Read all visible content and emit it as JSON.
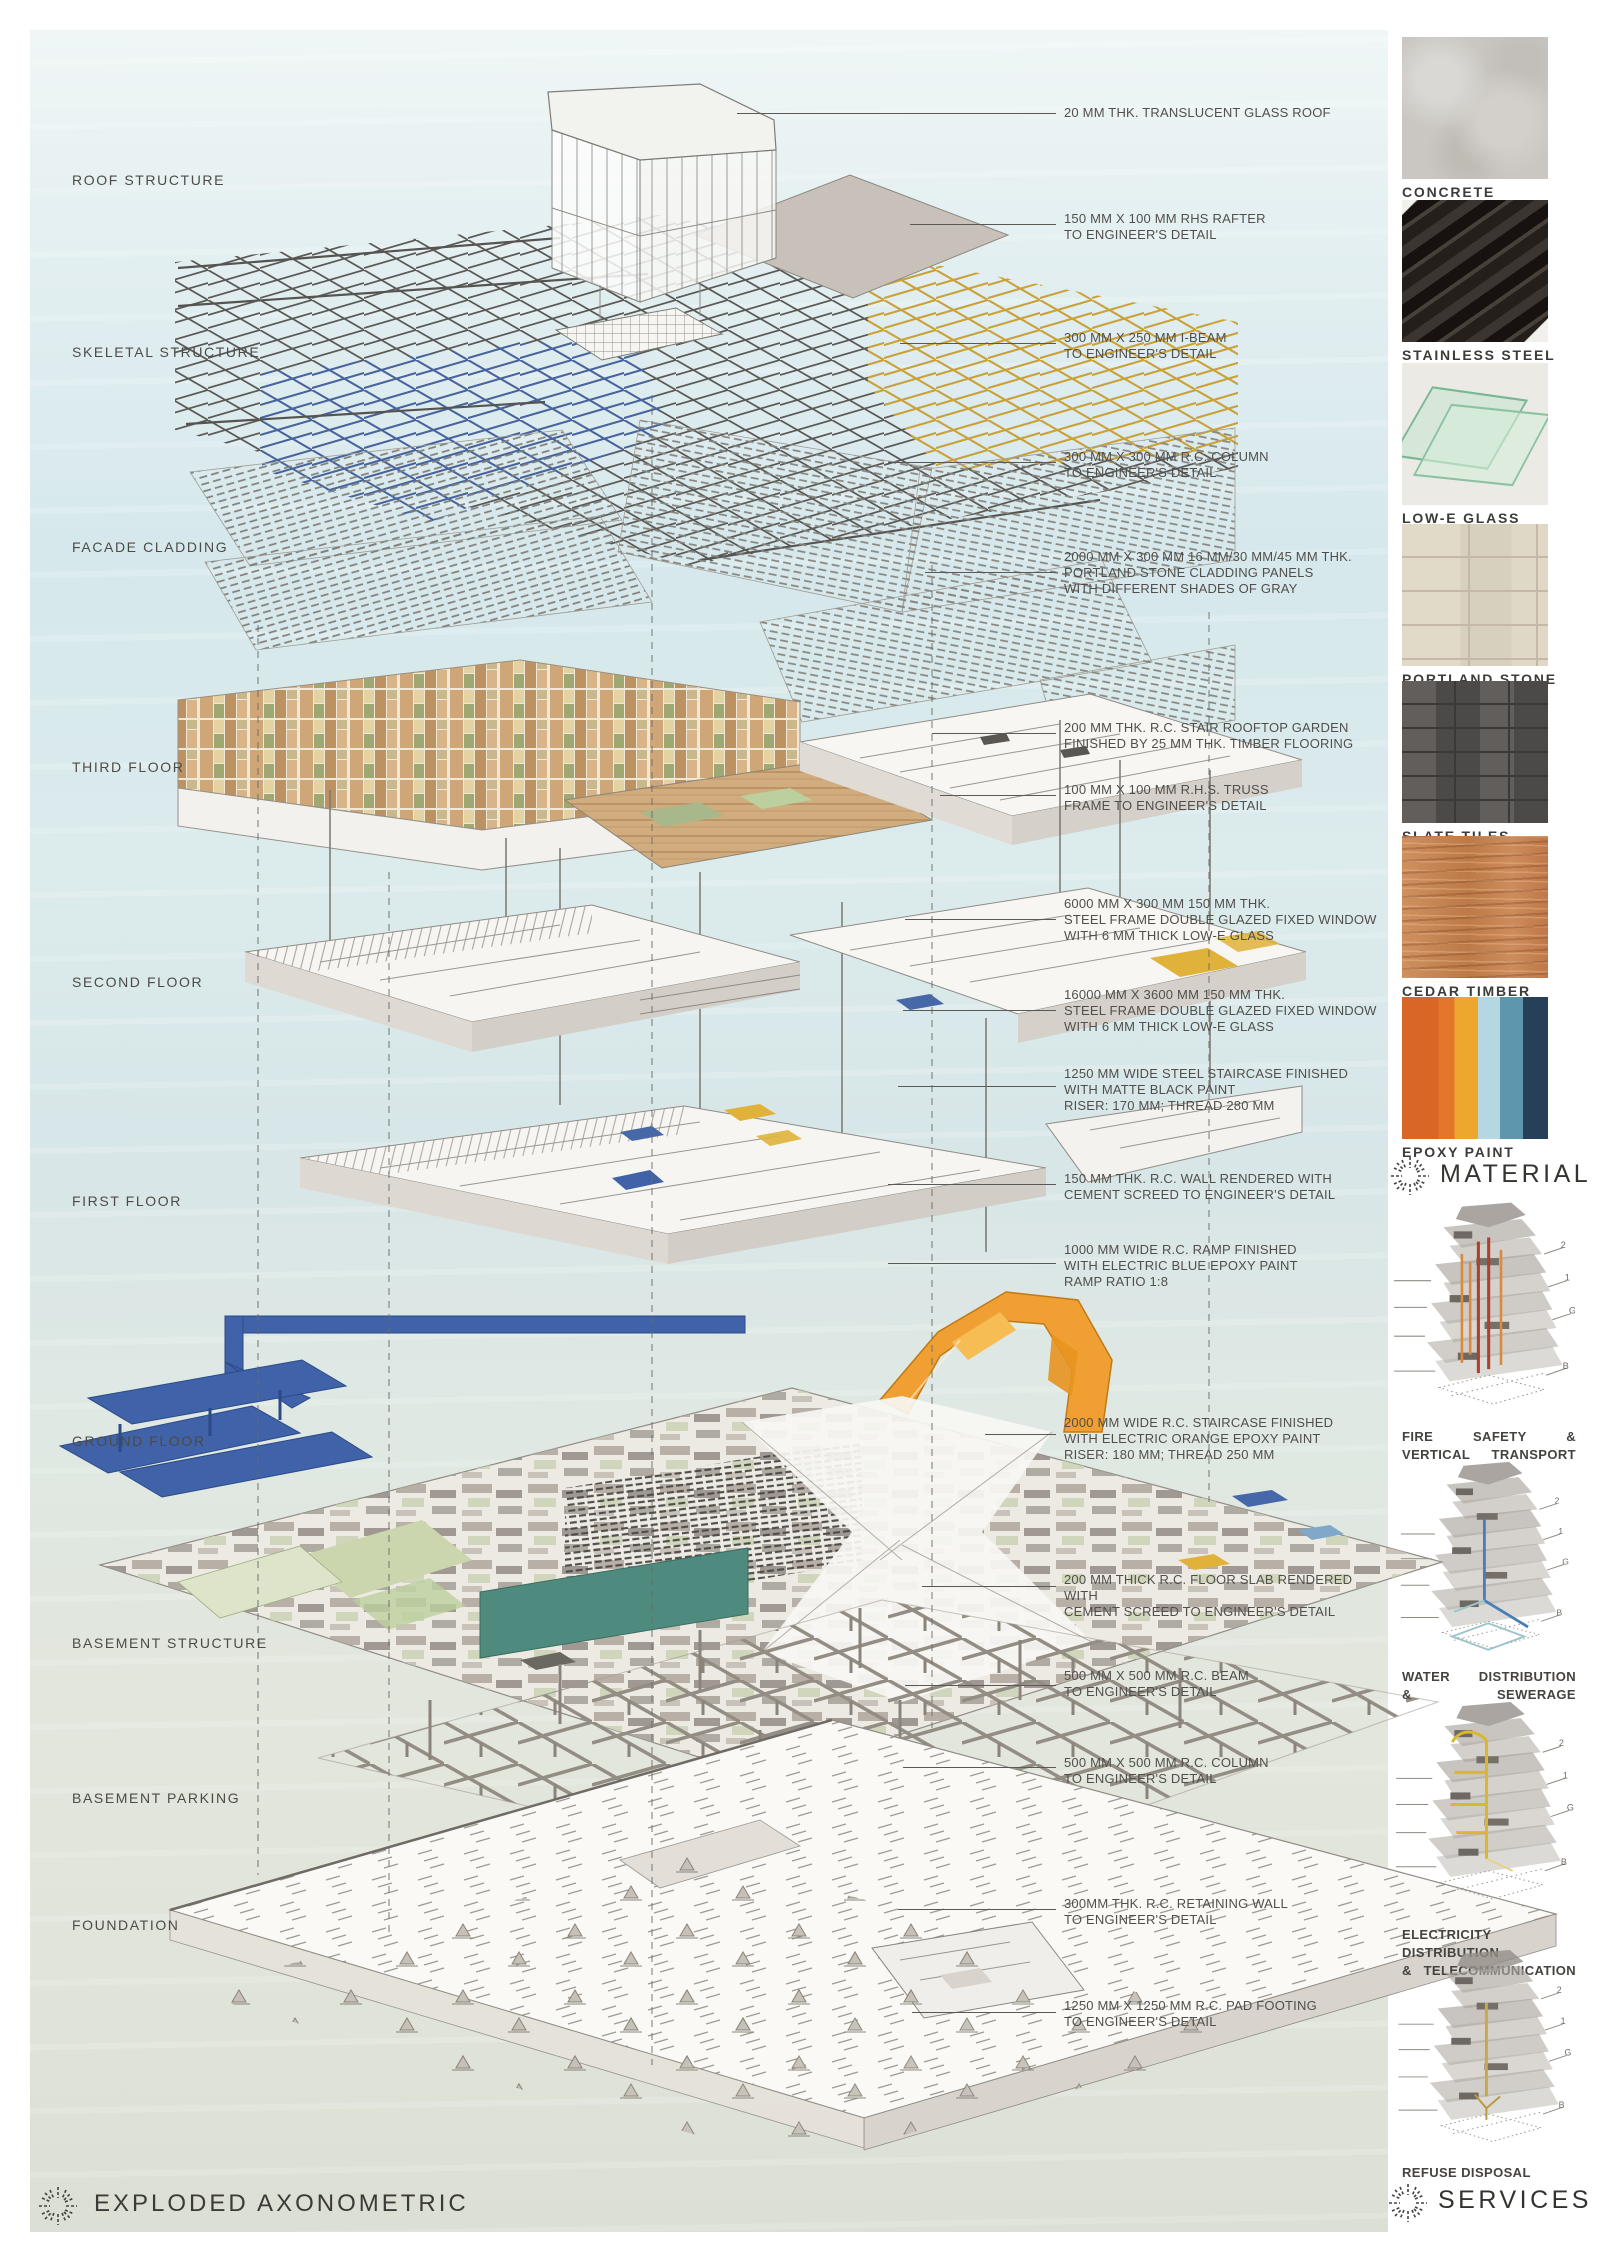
{
  "headings": {
    "title": "EXPLODED AXONOMETRIC",
    "material": "MATERIAL",
    "services": "SERVICES"
  },
  "floor_labels": [
    {
      "label": "ROOF STRUCTURE",
      "top": 172
    },
    {
      "label": "SKELETAL STRUCTURE",
      "top": 344
    },
    {
      "label": "FACADE CLADDING",
      "top": 539
    },
    {
      "label": "THIRD FLOOR",
      "top": 759
    },
    {
      "label": "SECOND FLOOR",
      "top": 974
    },
    {
      "label": "FIRST FLOOR",
      "top": 1193
    },
    {
      "label": "GROUND FLOOR",
      "top": 1433
    },
    {
      "label": "BASEMENT STRUCTURE",
      "top": 1635
    },
    {
      "label": "BASEMENT PARKING",
      "top": 1790
    },
    {
      "label": "FOUNDATION",
      "top": 1917
    }
  ],
  "annotations": [
    {
      "lines": [
        "20 MM THK. TRANSLUCENT GLASS ROOF",
        "",
        ""
      ],
      "ly": 113,
      "ty": 105,
      "x1": 737,
      "lw": 319
    },
    {
      "lines": [
        "150 MM X 100 MM RHS RAFTER",
        "TO ENGINEER'S DETAIL",
        ""
      ],
      "ly": 224,
      "ty": 211,
      "x1": 910,
      "lw": 146
    },
    {
      "lines": [
        "300 MM X 250 MM I-BEAM",
        "TO ENGINEER'S DETAIL",
        ""
      ],
      "ly": 343,
      "ty": 330,
      "x1": 900,
      "lw": 156
    },
    {
      "lines": [
        "300 MM X 300 MM R.C. COLUMN",
        "TO ENGINEER'S DETAIL",
        ""
      ],
      "ly": 462,
      "ty": 449,
      "x1": 888,
      "lw": 168
    },
    {
      "lines": [
        "2000 MM X 300 MM 16 MM/30 MM/45 MM THK.",
        "PORTLAND STONE CLADDING PANELS",
        "WITH DIFFERENT SHADES OF GRAY"
      ],
      "ly": 572,
      "ty": 549,
      "x1": 925,
      "lw": 131
    },
    {
      "lines": [
        "200 MM THK. R.C. STAIR ROOFTOP GARDEN",
        "FINISHED BY 25 MM THK. TIMBER FLOORING",
        ""
      ],
      "ly": 733,
      "ty": 720,
      "x1": 932,
      "lw": 124
    },
    {
      "lines": [
        "100 MM X 100 MM R.H.S. TRUSS",
        "FRAME TO ENGINEER'S DETAIL",
        ""
      ],
      "ly": 795,
      "ty": 782,
      "x1": 940,
      "lw": 116
    },
    {
      "lines": [
        "6000 MM X 300 MM 150 MM THK.",
        "STEEL FRAME DOUBLE GLAZED FIXED WINDOW",
        "WITH 6 MM THICK LOW-E GLASS"
      ],
      "ly": 919,
      "ty": 896,
      "x1": 905,
      "lw": 151
    },
    {
      "lines": [
        "16000 MM X 3600 MM 150 MM THK.",
        "STEEL FRAME DOUBLE GLAZED FIXED WINDOW",
        "WITH 6 MM THICK LOW-E GLASS"
      ],
      "ly": 1010,
      "ty": 987,
      "x1": 903,
      "lw": 153
    },
    {
      "lines": [
        "1250 MM WIDE STEEL STAIRCASE FINISHED",
        "WITH MATTE BLACK PAINT",
        "RISER: 170 MM; THREAD 280 MM"
      ],
      "ly": 1086,
      "ty": 1066,
      "x1": 898,
      "lw": 158
    },
    {
      "lines": [
        "150 MM THK. R.C. WALL RENDERED WITH",
        "CEMENT SCREED TO ENGINEER'S DETAIL",
        ""
      ],
      "ly": 1184,
      "ty": 1171,
      "x1": 888,
      "lw": 168
    },
    {
      "lines": [
        "1000 MM WIDE R.C. RAMP FINISHED",
        "WITH ELECTRIC BLUE EPOXY PAINT",
        "RAMP RATIO 1:8"
      ],
      "ly": 1263,
      "ty": 1242,
      "x1": 888,
      "lw": 168
    },
    {
      "lines": [
        "2000 MM WIDE R.C. STAIRCASE FINISHED",
        "WITH ELECTRIC ORANGE EPOXY PAINT",
        "RISER: 180 MM; THREAD 250 MM"
      ],
      "ly": 1434,
      "ty": 1415,
      "x1": 985,
      "lw": 71
    },
    {
      "lines": [
        "200 MM THICK R.C. FLOOR SLAB RENDERED WITH",
        "CEMENT SCREED TO ENGINEER'S DETAIL",
        ""
      ],
      "ly": 1586,
      "ty": 1572,
      "x1": 922,
      "lw": 134
    },
    {
      "lines": [
        "500 MM X 500 MM R.C. BEAM",
        "TO ENGINEER'S DETAIL",
        ""
      ],
      "ly": 1685,
      "ty": 1668,
      "x1": 905,
      "lw": 151
    },
    {
      "lines": [
        "500 MM X 500 MM R.C. COLUMN",
        "TO ENGINEER'S DETAIL",
        ""
      ],
      "ly": 1767,
      "ty": 1755,
      "x1": 903,
      "lw": 153
    },
    {
      "lines": [
        "300MM THK. R.C. RETAINING WALL",
        "TO ENGINEER'S DETAIL",
        ""
      ],
      "ly": 1909,
      "ty": 1896,
      "x1": 898,
      "lw": 158
    },
    {
      "lines": [
        "1250 MM X 1250 MM R.C. PAD FOOTING",
        "TO ENGINEER'S DETAIL",
        ""
      ],
      "ly": 2012,
      "ty": 1998,
      "x1": 912,
      "lw": 144
    }
  ],
  "materials": [
    {
      "name": "CONCRETE",
      "top": 37,
      "css": "sw-concrete",
      "color": "#cac7c2"
    },
    {
      "name": "STAINLESS STEEL",
      "top": 200,
      "css": "sw-steel",
      "color": "#28231f"
    },
    {
      "name": "LOW-E GLASS",
      "top": 363,
      "css": "sw-glass",
      "color": "#bfe0cb"
    },
    {
      "name": "PORTLAND STONE",
      "top": 524,
      "css": "sw-portland",
      "color": "#ddd5c4"
    },
    {
      "name": "SLATE TILES",
      "top": 681,
      "css": "sw-slate",
      "color": "#555250"
    },
    {
      "name": "CEDAR TIMBER",
      "top": 836,
      "css": "sw-cedar",
      "color": "#c9875a"
    },
    {
      "name": "EPOXY PAINT",
      "top": 997,
      "css": "sw-epoxy",
      "color": "#d96627"
    }
  ],
  "epoxy_stops": [
    {
      "color": "#d96627",
      "to": 25
    },
    {
      "color": "#e4762b",
      "to": 36
    },
    {
      "color": "#eda72e",
      "to": 52
    },
    {
      "color": "#b5d7e2",
      "to": 67
    },
    {
      "color": "#5e96ad",
      "to": 83
    },
    {
      "color": "#27405a",
      "to": 100
    }
  ],
  "services": [
    {
      "lines": [
        "FIRE SAFETY &",
        "VERTICAL TRANSPORT"
      ],
      "accent": "#b0402e",
      "accent2": "#d98a3a"
    },
    {
      "lines": [
        "WATER DISTRIBUTION",
        "& SEWERAGE"
      ],
      "accent": "#4a7fb5",
      "accent2": "#9cc4c9"
    },
    {
      "lines": [
        "ELECTRICITY DISTRIBUTION",
        "& TELECOMMUNICATION"
      ],
      "accent": "#d9b830",
      "accent2": "#e6d28a"
    },
    {
      "lines": [
        "REFUSE DISPOSAL",
        ""
      ],
      "accent": "#c9a84c",
      "accent2": "#b99a3e"
    }
  ],
  "service_ticks": [
    "2",
    "1",
    "G",
    "B"
  ],
  "drawing_colors": {
    "steel_yellow": "#d0a63a",
    "steel_blue": "#4668a8",
    "ramp_blue": "#3f62a8",
    "stair_orange": "#f0a032",
    "teal_panel": "#4e8a7e",
    "garden_green": "#ccd6ae",
    "amber": "#e0b23a"
  }
}
